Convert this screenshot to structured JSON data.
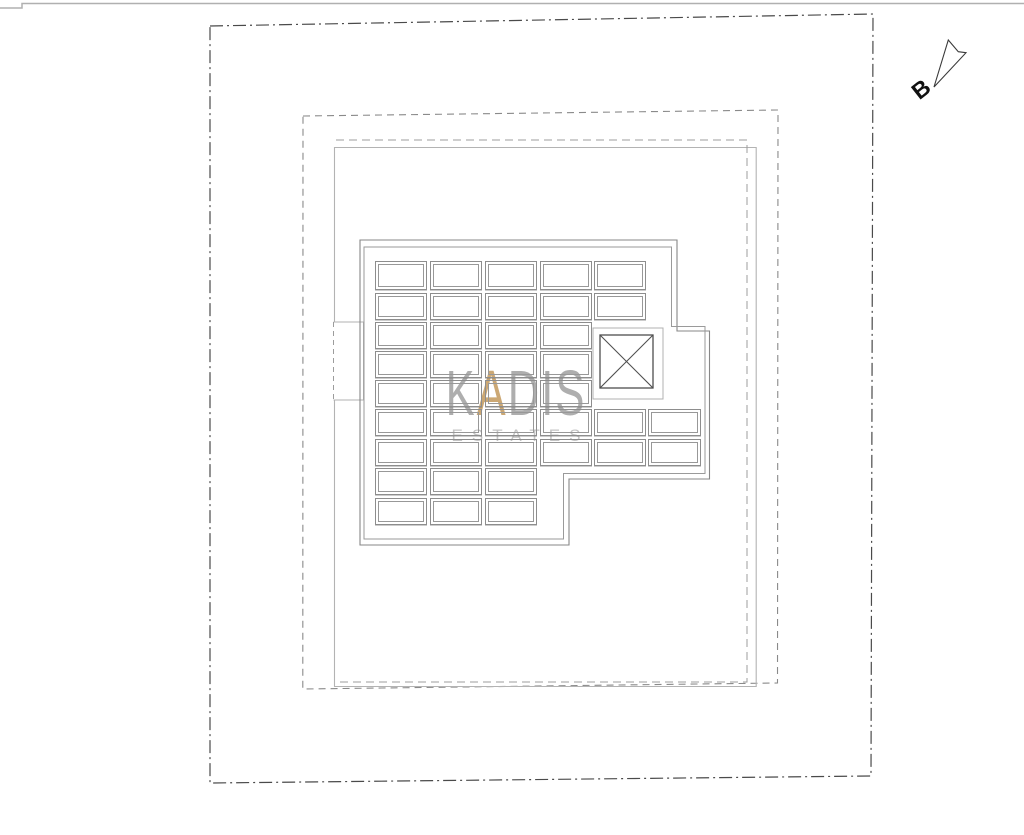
{
  "watermark": {
    "brand_prefix": "K",
    "brand_accent": "A",
    "brand_suffix": "DIS",
    "subtitle": "ESTATES",
    "brand_color": "#7d7d7d",
    "accent_color": "#c3995c",
    "subtitle_color": "#a5a5a5"
  },
  "compass": {
    "label": "B",
    "icon": "north-arrow-icon"
  },
  "drawing": {
    "description": "roof plan linework",
    "line_colors": {
      "plot_boundary_dashdot": "#4a4a4a",
      "setback_dashed": "#8a8a8a",
      "setback_solid": "#b3b3b3",
      "building_outline": "#878787",
      "panel_border": "#8d8d8d",
      "shaft_cross": "#4f4f4f"
    },
    "grid": {
      "col_x": [
        374.5,
        429.5,
        484.5,
        539.5,
        593.5,
        648
      ],
      "col_w": 52.5,
      "rows": [
        {
          "y": 261,
          "h": 29,
          "cols": [
            0,
            1,
            2,
            3,
            4
          ]
        },
        {
          "y": 292.5,
          "h": 27,
          "cols": [
            0,
            1,
            2,
            3,
            4
          ]
        },
        {
          "y": 321.5,
          "h": 27,
          "cols": [
            0,
            1,
            2,
            3
          ]
        },
        {
          "y": 350.5,
          "h": 27,
          "cols": [
            0,
            1,
            2,
            3
          ]
        },
        {
          "y": 379.5,
          "h": 27,
          "cols": [
            0,
            1,
            2,
            3
          ]
        },
        {
          "y": 409,
          "h": 27,
          "cols": [
            0,
            1,
            2,
            3,
            4,
            5
          ]
        },
        {
          "y": 438.5,
          "h": 27,
          "cols": [
            0,
            1,
            2,
            3,
            4,
            5
          ]
        },
        {
          "y": 468,
          "h": 27,
          "cols": [
            0,
            1,
            2
          ]
        },
        {
          "y": 497.5,
          "h": 27,
          "cols": [
            0,
            1,
            2
          ]
        }
      ]
    }
  }
}
